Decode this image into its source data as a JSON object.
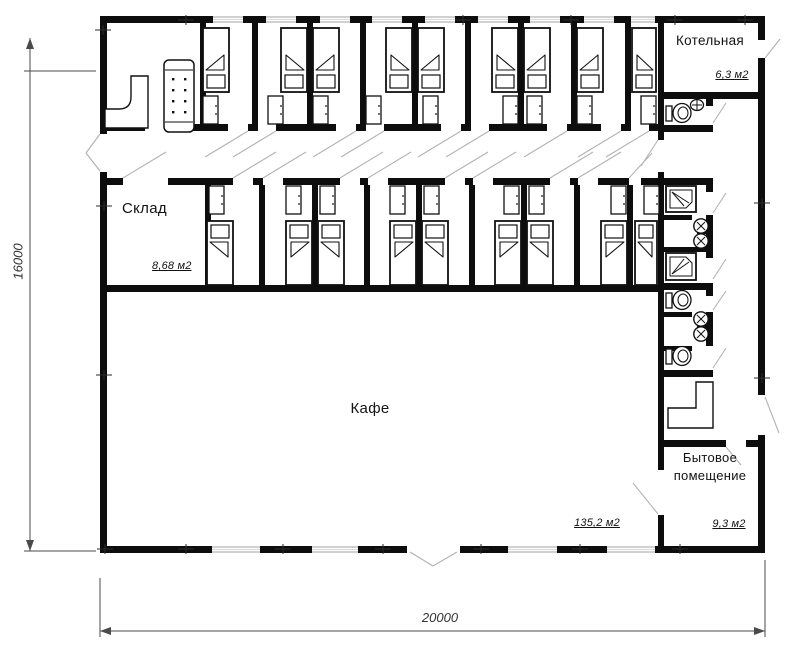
{
  "plan": {
    "rooms": {
      "kotelnaya": {
        "name": "Котельная",
        "area": "6,3 м2"
      },
      "sklad": {
        "name": "Склад",
        "area": "8,68 м2"
      },
      "kafe": {
        "name": "Кафе",
        "area": "135,2 м2"
      },
      "bytovoe": {
        "name_line1": "Бытовое",
        "name_line2": "помещение",
        "area": "9,3 м2"
      }
    },
    "dimensions": {
      "height_mm": "16000",
      "width_mm": "20000"
    },
    "colors": {
      "wall": "#0d0d0d",
      "door_swing": "#b3b3b3",
      "dimension": "#4a4a4a"
    }
  }
}
